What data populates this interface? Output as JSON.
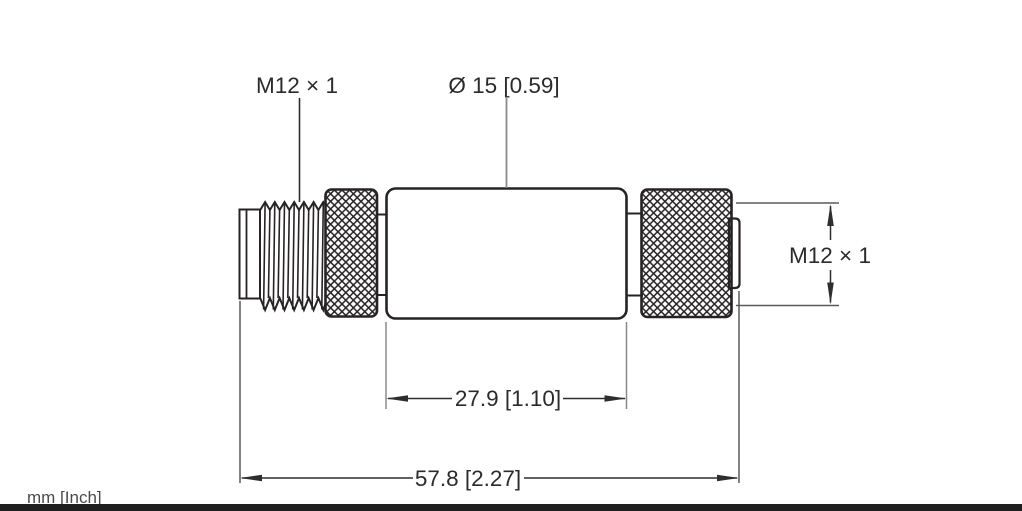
{
  "drawing": {
    "labels": {
      "thread_left": "M12 × 1",
      "body_diameter": "Ø 15 [0.59]",
      "thread_right": "M12 × 1",
      "body_length": "27.9 [1.10]",
      "overall_length": "57.8 [2.27]",
      "units": "mm [Inch]"
    },
    "dimensions": {
      "thread_spec": "M12 × 1",
      "body_diameter_mm": 15,
      "body_diameter_inch": 0.59,
      "body_length_mm": 27.9,
      "body_length_inch": 1.1,
      "overall_length_mm": 57.8,
      "overall_length_inch": 2.27
    },
    "colors": {
      "outline": "#272324",
      "dimension_line": "#2e2e2e",
      "extension_line": "#5a5a5a",
      "light_extension_line": "#8a8a8a",
      "footer_bar": "#1f1f1f",
      "background": "#ffffff"
    }
  }
}
